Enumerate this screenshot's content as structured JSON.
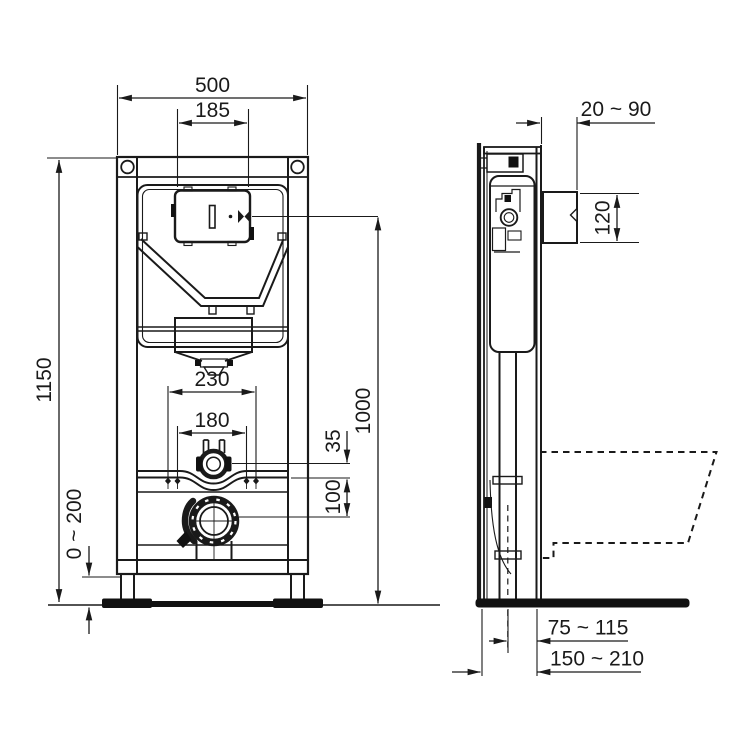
{
  "page": {
    "background": "#ffffff",
    "line_color": "#1a1a1a",
    "drawing_type": "installation frame technical drawing, front and side view"
  },
  "front_view": {
    "dim_overall_width": "500",
    "dim_flush_plate_cutout_width": "185",
    "dim_frame_height": "1150",
    "dim_foot_adjustment": "0 ~ 200",
    "dim_fixing_bolt_spacing_outer": "230",
    "dim_fixing_bolt_spacing_inner": "180",
    "dim_flush_pipe_above_rail": "35",
    "dim_outlet_below_rail": "100",
    "dim_plate_centre_height": "1000"
  },
  "side_view": {
    "dim_wall_distance_range": "20 ~ 90",
    "dim_flush_bend_height": "120",
    "dim_outlet_centre_to_front": "75 ~ 115",
    "dim_frame_depth_range": "150 ~ 210"
  }
}
